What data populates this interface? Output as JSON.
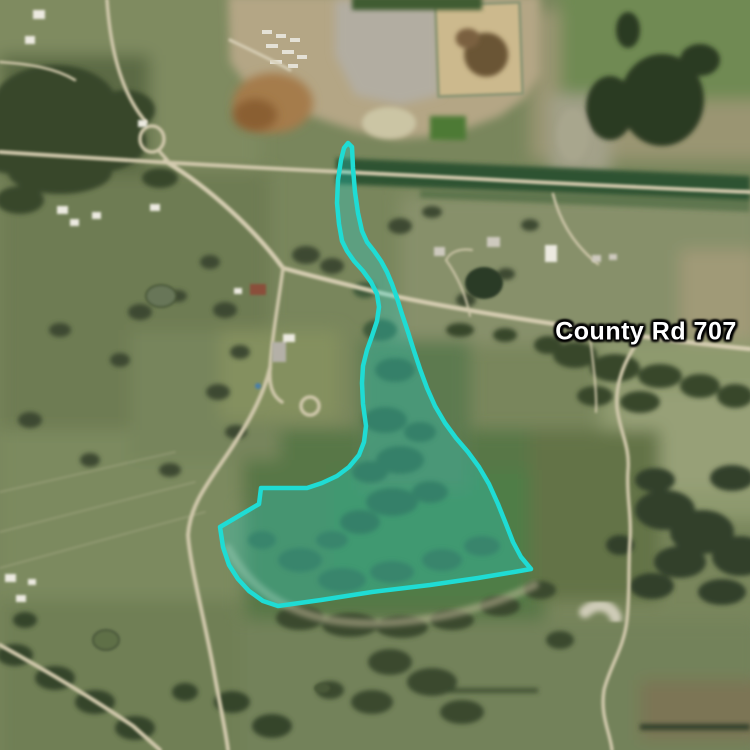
{
  "map": {
    "view_type": "satellite",
    "labels": [
      {
        "id": "county-rd-707",
        "text": "County Rd 707",
        "x": 646,
        "y": 332,
        "text_color": "#ffffff",
        "halo_color": "#000000"
      }
    ],
    "parcel_overlay": {
      "stroke_color": "#1fdcd4",
      "fill_color": "#1fdcd4",
      "fill_opacity": 0.3,
      "stroke_width": 4.5,
      "points": [
        [
          348,
          143
        ],
        [
          352,
          147
        ],
        [
          353,
          168
        ],
        [
          355,
          192
        ],
        [
          358,
          213
        ],
        [
          362,
          231
        ],
        [
          367,
          242
        ],
        [
          374,
          251
        ],
        [
          381,
          261
        ],
        [
          387,
          272
        ],
        [
          392,
          284
        ],
        [
          397,
          298
        ],
        [
          402,
          314
        ],
        [
          408,
          332
        ],
        [
          414,
          351
        ],
        [
          420,
          369
        ],
        [
          427,
          388
        ],
        [
          435,
          406
        ],
        [
          445,
          423
        ],
        [
          456,
          438
        ],
        [
          468,
          452
        ],
        [
          479,
          467
        ],
        [
          489,
          484
        ],
        [
          498,
          504
        ],
        [
          506,
          524
        ],
        [
          513,
          542
        ],
        [
          521,
          557
        ],
        [
          531,
          569
        ],
        [
          514,
          572
        ],
        [
          478,
          578
        ],
        [
          430,
          585
        ],
        [
          372,
          592
        ],
        [
          321,
          600
        ],
        [
          278,
          606
        ],
        [
          263,
          601
        ],
        [
          249,
          591
        ],
        [
          238,
          579
        ],
        [
          229,
          565
        ],
        [
          223,
          547
        ],
        [
          220,
          527
        ],
        [
          259,
          504
        ],
        [
          261,
          488
        ],
        [
          291,
          488
        ],
        [
          307,
          488
        ],
        [
          322,
          483
        ],
        [
          337,
          476
        ],
        [
          349,
          467
        ],
        [
          359,
          455
        ],
        [
          364,
          442
        ],
        [
          366,
          426
        ],
        [
          363,
          404
        ],
        [
          362,
          383
        ],
        [
          363,
          366
        ],
        [
          367,
          350
        ],
        [
          372,
          336
        ],
        [
          377,
          321
        ],
        [
          379,
          307
        ],
        [
          377,
          294
        ],
        [
          371,
          282
        ],
        [
          363,
          271
        ],
        [
          354,
          261
        ],
        [
          347,
          251
        ],
        [
          342,
          241
        ],
        [
          339,
          224
        ],
        [
          337,
          203
        ],
        [
          338,
          180
        ],
        [
          341,
          160
        ],
        [
          344,
          148
        ]
      ]
    }
  }
}
